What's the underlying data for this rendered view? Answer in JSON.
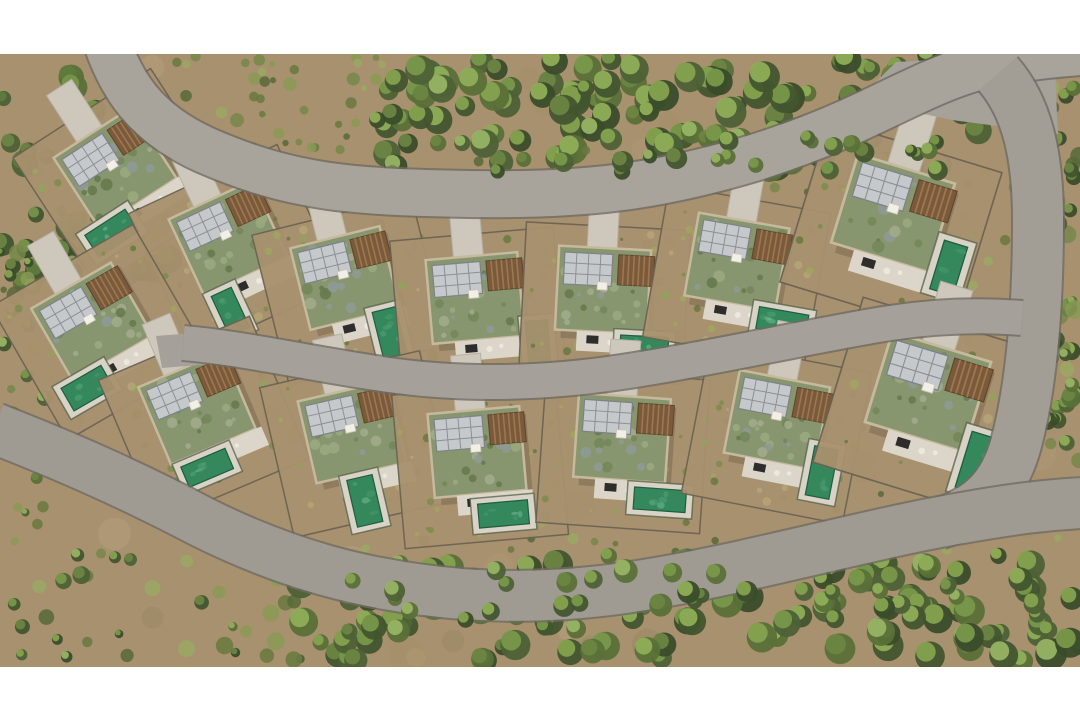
{
  "scene": {
    "canvas": {
      "width": 1080,
      "height": 720,
      "photo_top": 54,
      "photo_height": 613,
      "letterbox_color": "#ffffff"
    },
    "palette": {
      "ground": "#a8916e",
      "dirt": [
        "#b29b79",
        "#93805f",
        "#a38d66",
        "#bca887"
      ],
      "scrub": [
        "#77874a",
        "#8a9a55",
        "#69793f",
        "#9aa862",
        "#57683a"
      ],
      "tree_dark": [
        "#42552f",
        "#3a4c2a",
        "#4d6136",
        "#5a7038"
      ],
      "tree_light": [
        "#84a24e",
        "#8fae57",
        "#79984a",
        "#97b464",
        "#6b8542"
      ],
      "road_edge": "#6f6c64",
      "roof_base": "#88966f",
      "roof_mottle": [
        "#74875a",
        "#9aa87e",
        "#677a4e",
        "#a2ab8b",
        "#8e9a95"
      ],
      "garden_dots": [
        "#7c8d4e",
        "#93a25c",
        "#6a7b43",
        "#b4a476",
        "#a0a55e"
      ],
      "garden_wall": "#6b6353",
      "building_parapet": "#c6b99e",
      "terrace": "#dbd6c9",
      "furniture_dark": "#2e2d2b",
      "furniture_light": "#ece8dd",
      "driveway": "#cdc8bb",
      "solar_fill": "#c6c9cc",
      "solar_grid": "#8b9095",
      "solar_border": "#7d8287",
      "pergola_fill": "#7b5a3b",
      "pergola_slat": "#9c7850",
      "pergola_border": "#5f442c",
      "pool_deck": "#d8d3c6",
      "pool_water": "#35885c",
      "pool_light": [
        "#5aa87e",
        "#7fc3a0",
        "#4f9e74"
      ],
      "pool_edge": "#1f5e40",
      "hedge": "#4d5a40",
      "shadow": "#000000"
    },
    "roads": [
      {
        "name": "road-top",
        "d": "M 100,20 C 118,88 148,124 205,150 C 292,188 352,192 470,194 C 588,196 662,186 760,156 C 846,128 880,106 933,83 C 972,66 1002,58 1080,52",
        "width": 46,
        "color": "#a8a49c"
      },
      {
        "name": "road-right",
        "d": "M 998,74 C 1028,108 1038,158 1038,220 C 1038,300 1033,380 1016,444 C 1004,487 982,510 938,524",
        "width": 50,
        "color": "#a29e96"
      },
      {
        "name": "road-middle",
        "d": "M 183,343 C 242,348 302,362 382,374 C 462,386 542,384 622,372 C 702,360 792,340 872,326 C 922,317 972,314 1022,318",
        "width": 34,
        "color": "#a5a19a"
      },
      {
        "name": "road-bottom",
        "d": "M -6,428 C 60,454 122,480 202,522 C 282,562 362,586 462,594 C 562,601 642,588 742,566 C 832,546 902,528 962,518 C 1012,509 1046,505 1082,503",
        "width": 50,
        "color": "#9f9b93"
      }
    ],
    "road_pads": [
      {
        "name": "junction-pad",
        "d": "M 858,100 L 896,62 L 1054,54 L 1058,134 L 952,120 Z",
        "color": "#a6a29a"
      },
      {
        "name": "hammerhead-pad",
        "d": "M 156,336 L 206,332 L 212,364 L 162,368 Z",
        "color": "#a5a19a"
      }
    ],
    "regions": [
      {
        "name": "dirt-mottle",
        "x": 0,
        "y": 60,
        "w": 1080,
        "h": 600,
        "n": 60,
        "rmin": 8,
        "rmax": 20,
        "type": "dirt",
        "layer": "ground"
      },
      {
        "name": "top-left-trees",
        "x": 0,
        "y": 68,
        "w": 170,
        "h": 215,
        "n": 50,
        "rmin": 7,
        "rmax": 14,
        "type": "tree_dark",
        "layer": "ground"
      },
      {
        "name": "top-scrub",
        "x": 175,
        "y": 56,
        "w": 210,
        "h": 95,
        "n": 40,
        "rmin": 3,
        "rmax": 7,
        "type": "scrub",
        "layer": "ground"
      },
      {
        "name": "top-trees",
        "x": 375,
        "y": 54,
        "w": 640,
        "h": 115,
        "n": 115,
        "rmin": 8,
        "rmax": 16,
        "type": "tree",
        "layer": "ground"
      },
      {
        "name": "right-strip",
        "x": 1046,
        "y": 85,
        "w": 34,
        "h": 430,
        "n": 38,
        "rmin": 5,
        "rmax": 10,
        "type": "mix",
        "layer": "ground"
      },
      {
        "name": "mid-scrub-upper",
        "x": 0,
        "y": 150,
        "w": 1080,
        "h": 250,
        "n": 85,
        "rmin": 2.5,
        "rmax": 6,
        "type": "scrub",
        "layer": "ground"
      },
      {
        "name": "mid-scrub-lower",
        "x": 0,
        "y": 390,
        "w": 1080,
        "h": 170,
        "n": 75,
        "rmin": 2.5,
        "rmax": 6,
        "type": "scrub",
        "layer": "ground"
      },
      {
        "name": "bottom-left-scrub",
        "x": 0,
        "y": 545,
        "w": 310,
        "h": 115,
        "n": 35,
        "rmin": 4,
        "rmax": 9,
        "type": "mix",
        "layer": "ground"
      },
      {
        "name": "bottom-trees",
        "x": 300,
        "y": 555,
        "w": 780,
        "h": 108,
        "n": 115,
        "rmin": 8,
        "rmax": 16,
        "type": "tree",
        "layer": "ground"
      },
      {
        "name": "left-strip",
        "x": 0,
        "y": 245,
        "w": 48,
        "h": 310,
        "n": 28,
        "rmin": 4,
        "rmax": 9,
        "type": "mix",
        "layer": "ground"
      },
      {
        "name": "top-canopy-overhang",
        "x": 385,
        "y": 138,
        "w": 560,
        "h": 34,
        "n": 22,
        "rmin": 6,
        "rmax": 11,
        "type": "tree",
        "layer": "canopy"
      },
      {
        "name": "bottom-canopy-overhang",
        "x": 340,
        "y": 568,
        "w": 700,
        "h": 52,
        "n": 30,
        "rmin": 7,
        "rmax": 12,
        "type": "tree",
        "layer": "canopy"
      }
    ],
    "villa_template": {
      "garden": {
        "x": -80,
        "y": -64,
        "w": 164,
        "h": 154
      },
      "building": {
        "x": -46,
        "y": -42,
        "w": 92,
        "h": 84
      },
      "shadow_offset": {
        "dx": 6,
        "dy": 8,
        "opacity": 0.15
      },
      "driveway": {
        "x": -18,
        "y": -98,
        "w": 30,
        "h": 56
      },
      "solar": {
        "x": -40,
        "y": -36,
        "w": 48,
        "h": 32,
        "cols": 4,
        "rows": 3
      },
      "pergola": {
        "x": 14,
        "y": -36,
        "w": 36,
        "h": 30,
        "slats": 7
      },
      "rooflight": {
        "x": -6,
        "y": -8,
        "w": 10,
        "h": 8
      },
      "terrace": {
        "x": -24,
        "y": 42,
        "w": 76,
        "h": 20
      },
      "garden_dot_count": 26,
      "roof_dot_count": 22,
      "pool_deck_pad": 7
    },
    "villas": [
      {
        "name": "villa-u1",
        "cx": 115,
        "cy": 168,
        "rot": -33,
        "scale": 1,
        "pool": {
          "x": -62,
          "y": 40,
          "w": 48,
          "h": 26
        }
      },
      {
        "name": "villa-u2",
        "cx": 228,
        "cy": 238,
        "rot": -25,
        "scale": 1,
        "pool": {
          "x": -40,
          "y": 46,
          "w": 22,
          "h": 44
        }
      },
      {
        "name": "villa-u3",
        "cx": 345,
        "cy": 278,
        "rot": -14,
        "scale": 1,
        "pool": {
          "x": 18,
          "y": 40,
          "w": 24,
          "h": 48
        }
      },
      {
        "name": "villa-u4",
        "cx": 475,
        "cy": 298,
        "rot": -5,
        "scale": 1,
        "pool": {
          "x": 48,
          "y": 28,
          "w": 22,
          "h": 46
        }
      },
      {
        "name": "villa-u5",
        "cx": 603,
        "cy": 290,
        "rot": 3,
        "scale": 1,
        "pool": {
          "x": 20,
          "y": 44,
          "w": 48,
          "h": 22
        }
      },
      {
        "name": "villa-u6",
        "cx": 737,
        "cy": 262,
        "rot": 10,
        "scale": 1,
        "pool": {
          "x": 30,
          "y": 40,
          "w": 50,
          "h": 22
        }
      },
      {
        "name": "villa-u7",
        "cx": 893,
        "cy": 213,
        "rot": 17,
        "scale": 1.1,
        "pool": {
          "x": 52,
          "y": 10,
          "w": 22,
          "h": 46
        }
      },
      {
        "name": "villa-l1",
        "cx": 92,
        "cy": 322,
        "rot": -30,
        "scale": 1,
        "pool": {
          "x": -60,
          "y": 42,
          "w": 46,
          "h": 26
        }
      },
      {
        "name": "villa-l2",
        "cx": 197,
        "cy": 408,
        "rot": -23,
        "scale": 1,
        "pool": {
          "x": -38,
          "y": 48,
          "w": 48,
          "h": 22
        }
      },
      {
        "name": "villa-l3",
        "cx": 352,
        "cy": 432,
        "rot": -13,
        "scale": 1,
        "pool": {
          "x": -16,
          "y": 46,
          "w": 26,
          "h": 48
        }
      },
      {
        "name": "villa-l4",
        "cx": 477,
        "cy": 452,
        "rot": -5,
        "scale": 1,
        "pool": {
          "x": -4,
          "y": 52,
          "w": 50,
          "h": 24
        }
      },
      {
        "name": "villa-l5",
        "cx": 622,
        "cy": 438,
        "rot": 4,
        "scale": 1,
        "pool": {
          "x": 16,
          "y": 48,
          "w": 52,
          "h": 22
        }
      },
      {
        "name": "villa-l6",
        "cx": 777,
        "cy": 420,
        "rot": 11,
        "scale": 1,
        "pool": {
          "x": 42,
          "y": 18,
          "w": 24,
          "h": 50
        }
      },
      {
        "name": "villa-l7",
        "cx": 928,
        "cy": 392,
        "rot": 17,
        "scale": 1.12,
        "pool": {
          "x": 48,
          "y": 22,
          "w": 26,
          "h": 52
        }
      }
    ],
    "seed": 20240711
  }
}
